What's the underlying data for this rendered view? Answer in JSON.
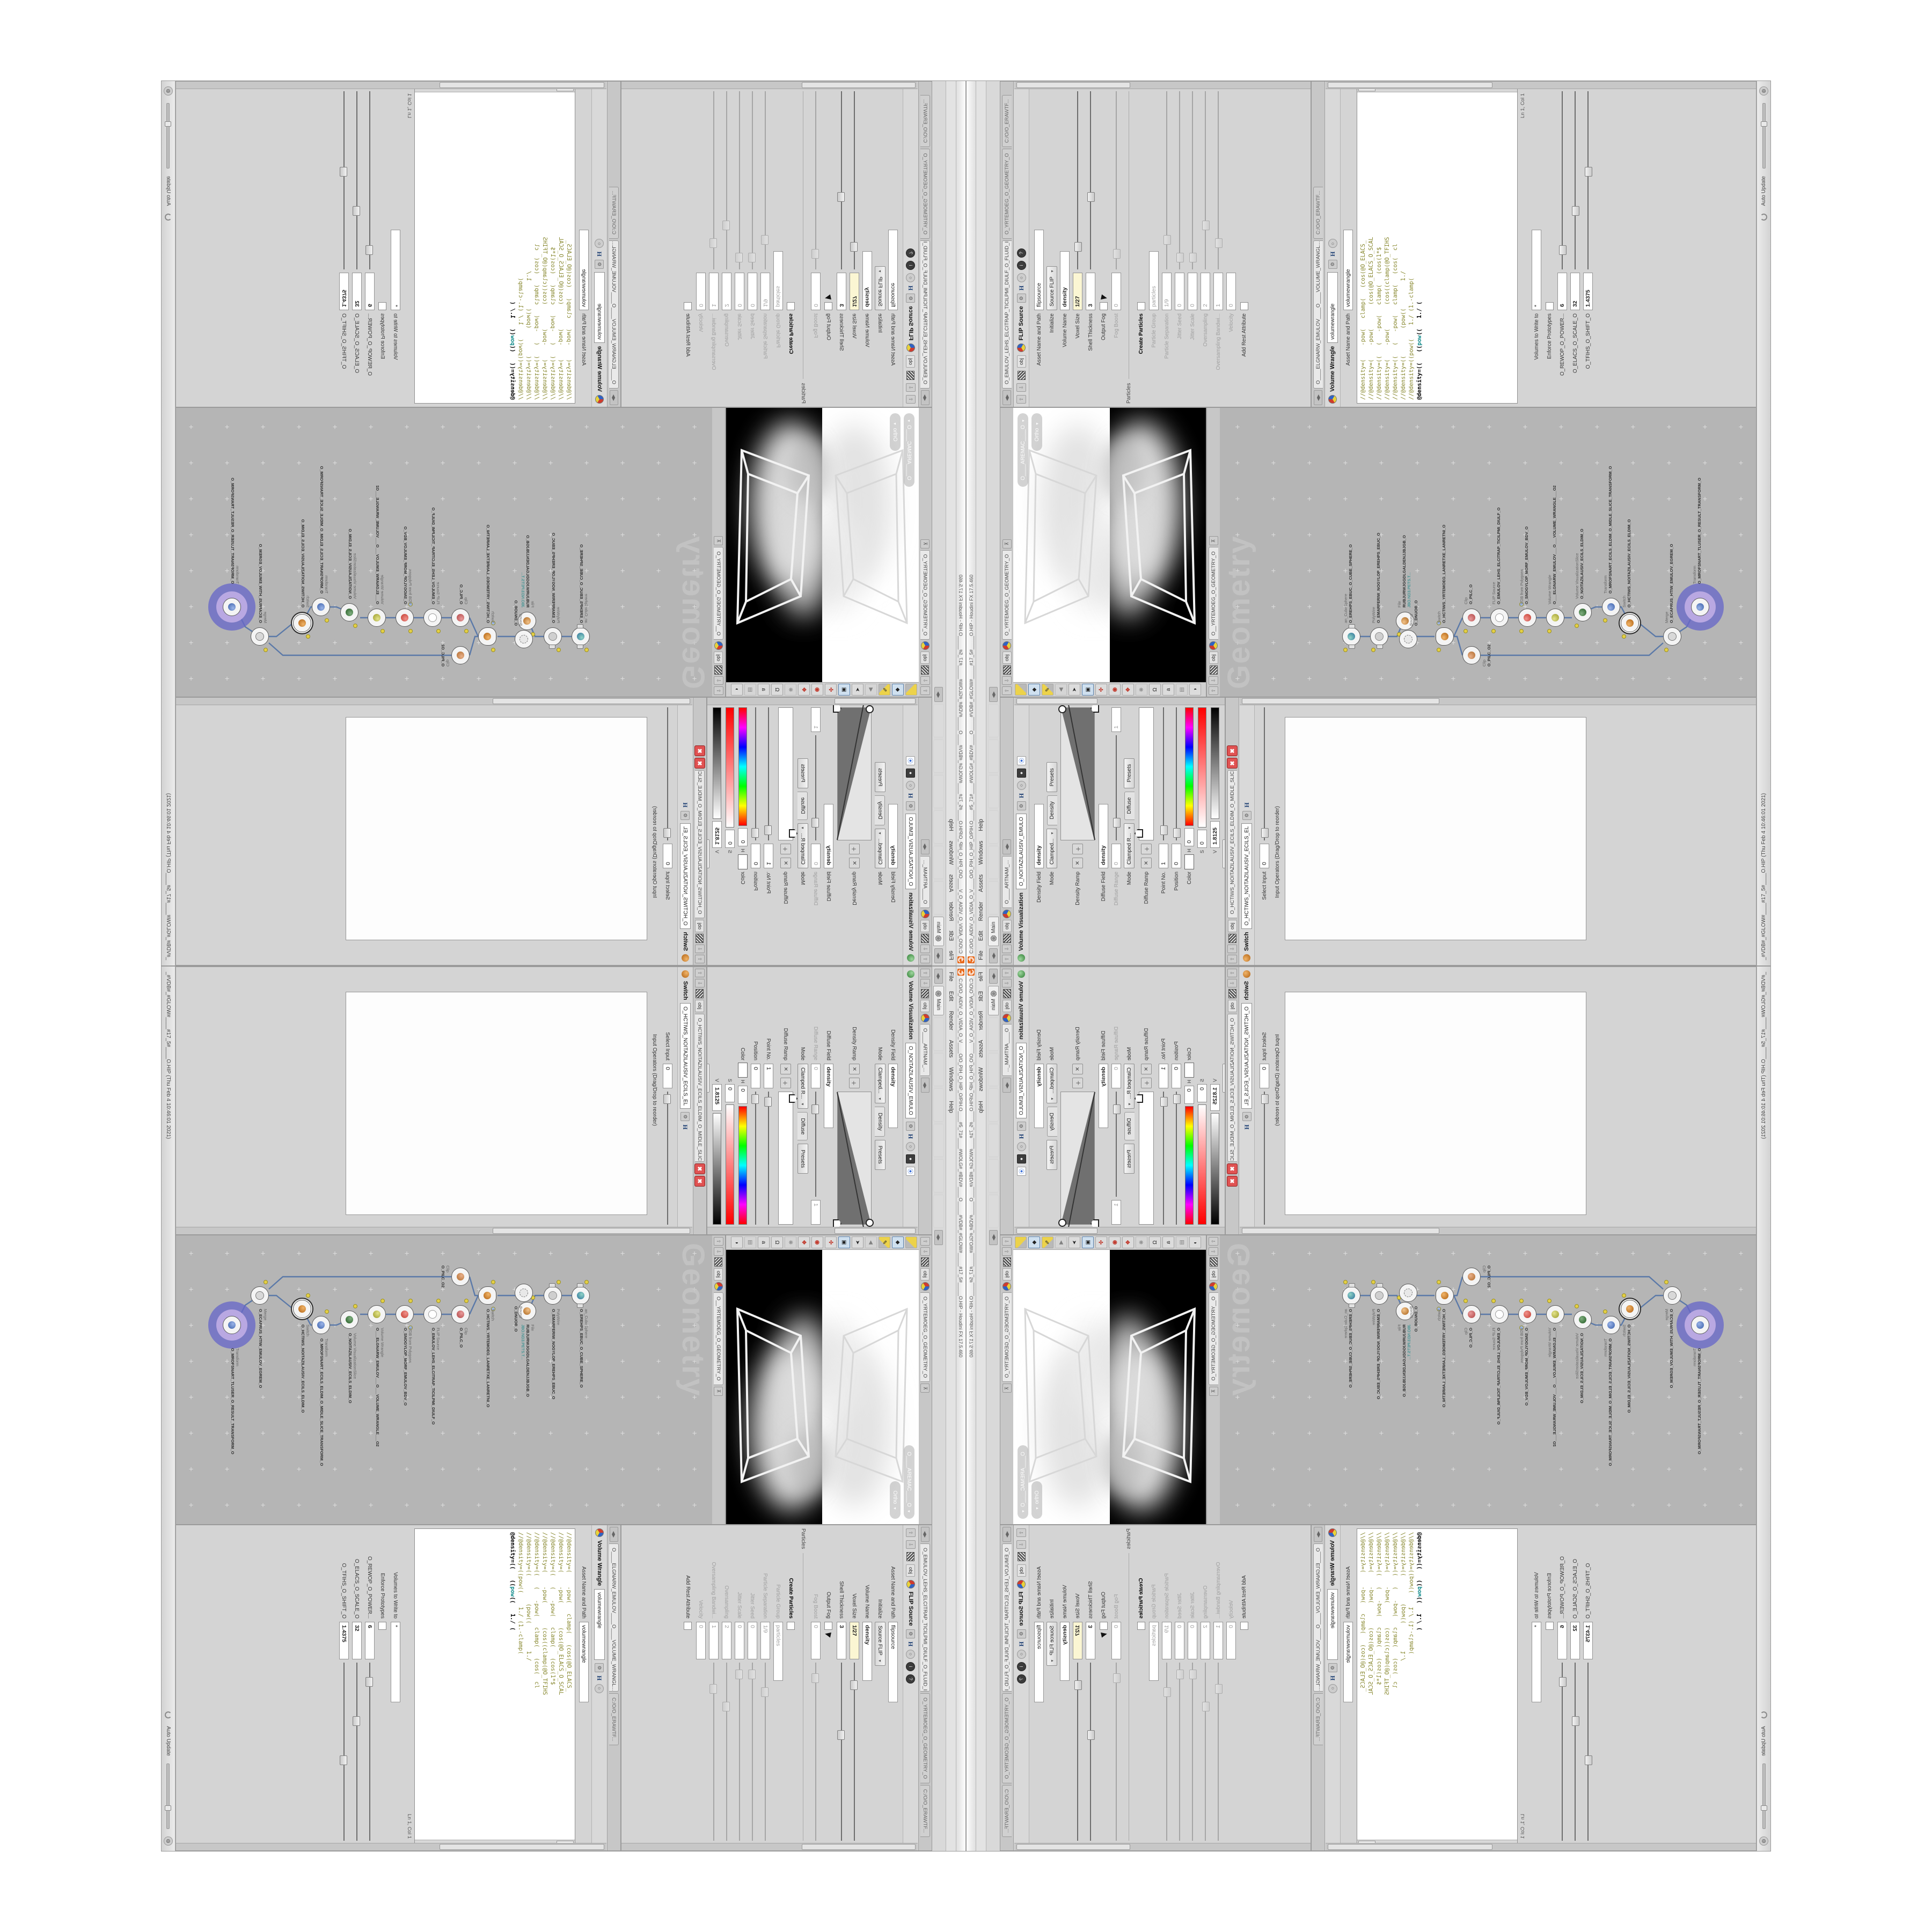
{
  "app": {
    "title": "C:/O/O_AIDIV_O_VIDIA_O_V____O/O_PIH_O_HIP_O/PIH.O____#5_71#____#WOLG#_#BDV#____O_____#VDB#_#GLOW#_____#17_5#_____O.HIP - Houdini FX 17.5.460",
    "menu": [
      "File",
      "Edit",
      "Render",
      "Assets",
      "Windows",
      "Help"
    ],
    "shelf_tab": "Main",
    "status_left": "_#VDB#_#GLOW#____#17_5#____O.HIP (Thu Feb  4 10:46:01 2021)",
    "auto_update": "Auto Update"
  },
  "colors": {
    "houdini_orange": "#e8691b",
    "halo_purple": "#7d7ccf",
    "wire_blue": "#5b79a8",
    "error_red": "#e05252",
    "code_olive": "#85852a",
    "code_teal": "#128b8b",
    "expression_field_yellow": "#fbf6d3",
    "network_bg": "#b5b5b5"
  },
  "viz": {
    "tab": "O____ARTNAM_...",
    "breadcrumb": "obj",
    "type_label": "Volume Visualization",
    "node_name": "O_NOITAZILAUSIV_EMULO",
    "density_field_label": "Density Field",
    "density_field_value": "density",
    "mode_label": "Mode",
    "mode_value": "Clamped...",
    "density_folder": "Density",
    "presets": "Presets",
    "density_ramp_label": "Density Ramp",
    "diffuse_field_label": "Diffuse Field",
    "diffuse_field_value": "density",
    "diffuse_range_label": "Diffuse Range",
    "diffuse_range_min": "0",
    "diffuse_range_max": "1",
    "mode2_value": "Clamped R...",
    "diffuse_folder": "Diffuse",
    "diffuse_ramp_label": "Diffuse Ramp",
    "point_label": "Point No.",
    "point_value": "1",
    "pos_label": "Position",
    "pos_value": "0",
    "color_label": "Color",
    "h_label": "H",
    "h_value": "0",
    "s_label": "S",
    "s_value": "0",
    "v_label": "V",
    "v_value": "1.8125",
    "interp_label": "Interpolation",
    "interp_value": "Linear"
  },
  "switch_pane": {
    "tab": "O_HCTIWS_NOITAZILAUSIV_ECILS_ELDIM_O_MIDLE_SLICE_VISUAL...",
    "breadcrumb": "obj",
    "type_label": "Switch",
    "node_name": "O_HCTIWS_NOITAZILAUSIV_ECILS_EL",
    "select_label": "Select Input",
    "select_value": "0",
    "list_label": "Input Operators (Drag/Drop to reorder)"
  },
  "viewport": {
    "tab": "O_YRTEMOEG_O_GEOMETRY_O",
    "breadcrumb": "obj",
    "camera_pill": "O____AREMAC____O",
    "ortho_pill": "Ortho"
  },
  "network": {
    "tab": "O__YRTEMOEG_O_GEOMETRY_O",
    "breadcrumb": "obj",
    "watermark": "Geometry",
    "nodes": [
      {
        "type": "an_CubeSphere",
        "name": "O_EREHPS_EBUC_O_CUBE_SPHERE_O"
      },
      {
        "type": "PolyWire",
        "name": "O_EMARFERIW_NOGYLOP_EREHPS_EBUC_O"
      },
      {
        "type": "File",
        "name": "RUBJURWJGGDLGALDENJJBJGB_O",
        "path": "JBO.ND3.PETS.T..."
      },
      {
        "type": "Bound",
        "name": "O_DNUOB_O"
      },
      {
        "type": "Switch",
        "name": "O_HCTIWS_YRTEMOEG_LANRETXE_LANRETNI_O"
      },
      {
        "type": "Clip",
        "name": "O_PILC_O"
      },
      {
        "type": "Clip",
        "name": "O_PILC_O2"
      },
      {
        "type": "FLIP Source",
        "name": "O_EMULOV_LEHS_ELCITRAP_TICILPMI_DIULF_O"
      },
      {
        "type": "VDB from Polygons",
        "name": "O_SNOGYLOP_MORF_EMULOV_BDV_O"
      },
      {
        "type": "Volume Wrangle",
        "name": "O___ELGNARW_EMULOV___O___VOLUME_WRANGLE___O2"
      },
      {
        "type": "Volume VisualizationSlice",
        "name": "O_NOITAZILAUSIV_ECILS_ELDIM_O"
      },
      {
        "type": "Transform",
        "name": "O_MROFSNART_ECILS_ELDIM_O_MIDLE_SLICE_TRANSFORM_O"
      },
      {
        "type": "Switch",
        "name": "O_HCTIWS_NOITAZILAUSIV_ECILS_ELDIM_O"
      },
      {
        "type": "Merge",
        "name": "O_ECAFRUS_HTIW_EMULOV_EGREM_O"
      },
      {
        "type": "Transform",
        "name": "O_MROFSNART_TLUSER_O_RESULT_TRANSFORM_O"
      }
    ]
  },
  "flip": {
    "tab": "O_EMULOV_LEHS_ELCITRAP_TICILPMI_DIULF_O_FLUID_IMPLICIT_PARTI...",
    "path_tab": "C:/O/O_ERAWTF...",
    "geo_tab": "O_YRTEMOEG_O_GEOMETRY_O",
    "type_label": "FLIP Source",
    "node_name": "flipsource",
    "asset_label": "Asset Name and Path",
    "initialize_label": "Initialize",
    "initialize_value": "Source FLIP",
    "volume_name_label": "Volume Name",
    "volume_name_value": "density",
    "voxel_label": "Voxel Size",
    "voxel_value": "1/27",
    "shell_label": "Shell Thickness",
    "shell_value": "3",
    "output_fog_label": "Output Fog",
    "fog_boost_label": "Fog Boost",
    "fog_boost_value": "0",
    "particles_section": "Particles",
    "create_particles_label": "Create Particles",
    "pgroup_label": "Particle Group",
    "pgroup_value": "particles",
    "psep_label": "Particle Separation",
    "psep_value": "1/9",
    "jseed_label": "Jitter Seed",
    "jseed_value": "0",
    "jscale_label": "Jitter Scale",
    "jscale_value": "0",
    "oversampling_label": "Oversampling",
    "oversampling_value": "2",
    "oband_label": "Oversampling Bandwi...",
    "oband_value": "1",
    "velocity_label": "Velocity",
    "velocity_value": "0",
    "rest_label": "Add Rest Attribute"
  },
  "wrangle": {
    "tab": "O____ELGNARW_EMULOV____O____VOLUME_WRANGL...",
    "path_tab": "C:/O/O_ERAWTF...",
    "type_label": "Volume Wrangle",
    "node_name": "volumewrangle",
    "asset_label": "Asset Name and Path",
    "code": [
      "//@density=(    -pow(   clamp(   (cos(@O_ELACS_",
      "//@density=(    -pow(       (cos(@O_ELACS_O_SCAL",
      "//@density=((   (   -pow(   clamp(   (cos(1*$",
      "//@density=(    -pow(       (cos((clamp(@O_TFIHS",
      "//@density=((   (   -pow(   clamp(   (cos(  cl",
      "//@density=((        (pow((        1./",
      "//@density=((pow((    1./ (1.-clamp("
    ],
    "active_pre": "@density=((   ((",
    "active_kw": "pow",
    "active_post": "((   1./ (",
    "lncol": "Ln 1, Col 1",
    "volumes_label": "Volumes to Write to",
    "volumes_value": "*",
    "enforce_label": "Enforce Prototypes",
    "p1_label": "O_REWOP_O_POWER...",
    "p1_value": "6",
    "p2_label": "O_ELACS_O_SCALE_O",
    "p2_value": "32",
    "p3_label": "O_TFIHS_O_SHIFT_O",
    "p3_value": "1.4375"
  }
}
